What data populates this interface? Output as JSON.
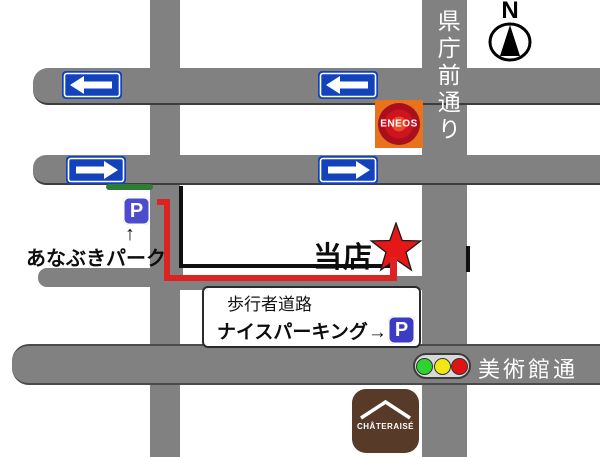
{
  "map": {
    "compass_label": "N",
    "streets": {
      "vertical": "県庁前通り",
      "horizontal": "美術館通り"
    },
    "store_label": "当店",
    "anabuki_parking": {
      "label": "あなぶきパーク",
      "pointer": "↑",
      "sign": "P"
    },
    "nice_parking": {
      "label": "ナイスパーキング→",
      "sign": "P"
    },
    "pedestrian_road_label": "歩行者道路",
    "logos": {
      "eneos": "ENEOS",
      "chateraise": "CHÂTERAISÉ"
    },
    "icons": {
      "one_way_left": "left-arrow-sign",
      "one_way_right": "right-arrow-sign",
      "store_marker": "red-star",
      "traffic_light": "green-yellow-red",
      "compass": "north-compass"
    },
    "colors": {
      "road_gray": "#818181",
      "sign_blue": "#1243bd",
      "parking_blue_1": "#4d4ccd",
      "parking_blue_2": "#3b3bc4",
      "route_red": "#dd2222",
      "star_red": "#e61717",
      "entrance_green": "#2e7d32",
      "eneos_orange": "#e8731c",
      "chateraise_brown": "#583a28",
      "traffic_green": "#2fd32f",
      "traffic_yellow": "#f2e713",
      "traffic_red": "#e01313"
    }
  }
}
